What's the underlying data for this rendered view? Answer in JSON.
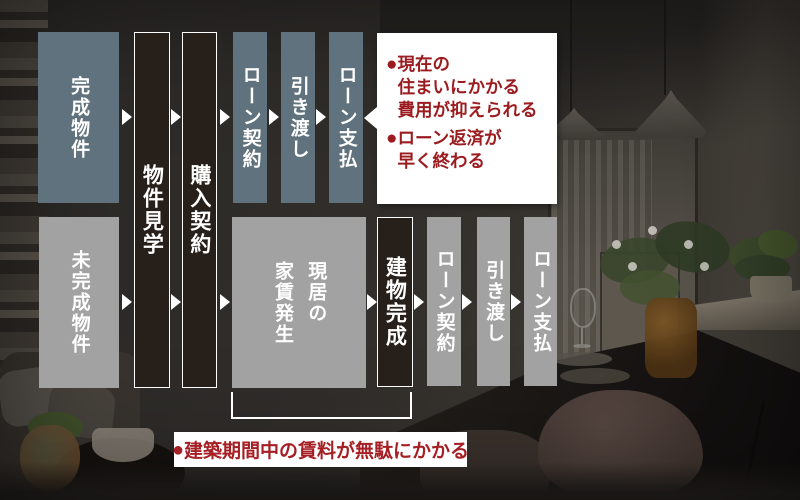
{
  "diagram_title": "物件購入フロー比較図",
  "colors": {
    "top_step_bg": "#60727d",
    "bottom_step_bg": "#a2a2a2",
    "milestone_bg": "#271f1a",
    "benefit_text": "#9b1b1f",
    "warning_text": "#a51f24",
    "arrow": "#ffffff"
  },
  "steps": {
    "completed": "完成物件",
    "viewing": "物件見学",
    "purchase": "購入契約",
    "loan_top": "ローン契約",
    "handover_top": "引き渡し",
    "payment_top": "ローン支払",
    "unfinished": "未完成物件",
    "rent": "現居の\n家賃発生",
    "building_done": "建物完成",
    "loan_bottom": "ローン契約",
    "handover_bottom": "引き渡し",
    "payment_bottom": "ローン支払"
  },
  "callouts": {
    "benefits": {
      "items": [
        {
          "bullet": "●",
          "text": "現在の\n住まいにかかる\n費用が抑えられる"
        },
        {
          "bullet": "●",
          "text": "ローン返済が\n早く終わる"
        }
      ]
    },
    "warning": {
      "bullet": "●",
      "text": "建築期間中の賃料が無駄にかかる"
    }
  }
}
